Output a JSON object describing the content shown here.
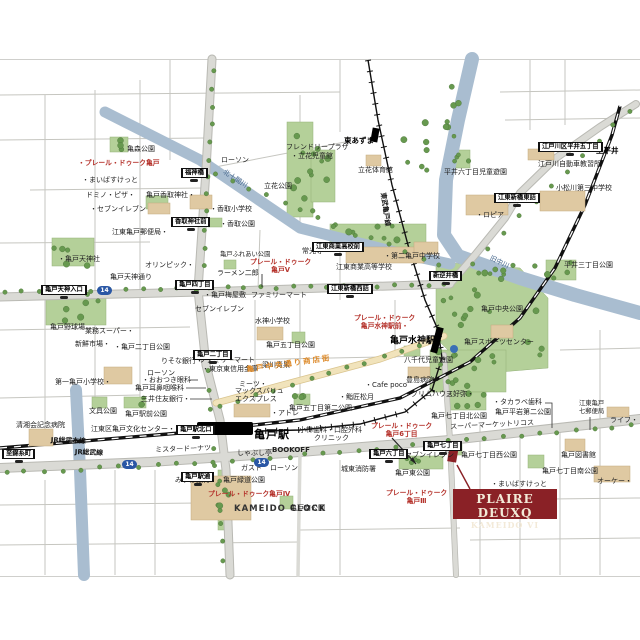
{
  "colors": {
    "brand_red": "#b5332c",
    "logo_red": "#8a2126",
    "road_gray": "#dadad5",
    "park_green": "#b4d099",
    "tree_green": "#67994f",
    "water_blue": "#a9bdd0",
    "rail_black": "#111111",
    "shop_street_orange": "#dd8a2a",
    "route_shield_blue": "#2a57a5"
  },
  "brand_box": {
    "line1": "PLAIRE DEUXQ",
    "line2": "KAMEIDO VI"
  },
  "map": {
    "labels": [
      {
        "text": "亀森公園",
        "x": 127,
        "y": 145
      },
      {
        "text": "・プレール・ドゥーク亀戸",
        "x": 78,
        "y": 159,
        "cls": "br",
        "name": "brand-label-kameido"
      },
      {
        "text": "・まいばすけっと",
        "x": 82,
        "y": 176
      },
      {
        "text": "ドミノ・ピザ・",
        "x": 86,
        "y": 191
      },
      {
        "text": "・セブンイレブン",
        "x": 90,
        "y": 205
      },
      {
        "text": "亀戸香取神社・",
        "x": 146,
        "y": 191
      },
      {
        "text": "ローソン",
        "x": 221,
        "y": 156
      },
      {
        "text": "・香取小学校",
        "x": 210,
        "y": 205
      },
      {
        "text": "・香取公園",
        "x": 220,
        "y": 220
      },
      {
        "text": "フレンドリープラザ",
        "x": 286,
        "y": 143
      },
      {
        "text": "・立花児童館",
        "x": 291,
        "y": 152
      },
      {
        "text": "立花公園",
        "x": 264,
        "y": 182
      },
      {
        "text": "東あずま",
        "x": 344,
        "y": 136,
        "cls": "pb",
        "name": "station-label-higashiazuma"
      },
      {
        "text": "立花体育館",
        "x": 358,
        "y": 166
      },
      {
        "text": "江戸川自動車教習所",
        "x": 538,
        "y": 160
      },
      {
        "text": "平井六丁目児童遊園",
        "x": 444,
        "y": 168
      },
      {
        "text": "小松川第三中学校",
        "x": 556,
        "y": 184
      },
      {
        "text": "・ロピア",
        "x": 476,
        "y": 211
      },
      {
        "text": "至平井",
        "x": 596,
        "y": 146,
        "cls": "pb"
      },
      {
        "text": "北十間川",
        "x": 226,
        "y": 168,
        "cls": "wt",
        "rot": 33,
        "name": "river-label-kitajukken"
      },
      {
        "text": "旧中川",
        "x": 492,
        "y": 254,
        "cls": "wt",
        "rot": 26,
        "name": "river-label-kyunakagawa"
      },
      {
        "text": "東武亀戸線",
        "x": 387,
        "y": 192,
        "cls": "rl",
        "rot": 82,
        "name": "rail-label-tobu"
      },
      {
        "text": "平井三丁目公園",
        "x": 564,
        "y": 261
      },
      {
        "text": "江東亀戸郵便局・",
        "x": 112,
        "y": 228
      },
      {
        "text": "・亀戸天神社",
        "x": 58,
        "y": 255
      },
      {
        "text": "オリンピック・",
        "x": 145,
        "y": 261
      },
      {
        "text": "亀戸天神通り",
        "x": 110,
        "y": 273
      },
      {
        "text": "ラーメン二郎",
        "x": 217,
        "y": 269
      },
      {
        "text": "亀戸ふれあい公園",
        "x": 220,
        "y": 251,
        "cls": "p2"
      },
      {
        "text": "・亀戸梅屋敷",
        "x": 204,
        "y": 291
      },
      {
        "text": "セブンイレブン",
        "x": 195,
        "y": 305
      },
      {
        "text": "常光寺・",
        "x": 302,
        "y": 247
      },
      {
        "text": "江東商業高等学校",
        "x": 336,
        "y": 263
      },
      {
        "text": "・第二亀戸中学校",
        "x": 384,
        "y": 252
      },
      {
        "text": "ファミリーマート",
        "x": 251,
        "y": 291
      },
      {
        "text": "プレール・ドゥーク\n亀戸V",
        "x": 250,
        "y": 258,
        "cls": "br2",
        "name": "brand-label-kameido-v"
      },
      {
        "text": "水神小学校",
        "x": 255,
        "y": 317
      },
      {
        "text": "亀戸五丁目公園",
        "x": 266,
        "y": 341
      },
      {
        "text": "プレール・ドゥーク\n亀戸水神駅前・",
        "x": 354,
        "y": 314,
        "cls": "br2",
        "name": "brand-label-suijin-ekimae"
      },
      {
        "text": "亀戸水神駅",
        "x": 390,
        "y": 336,
        "cls": "st2",
        "name": "station-label-kameido-suijin"
      },
      {
        "text": "亀戸中央公園",
        "x": 481,
        "y": 305
      },
      {
        "text": "亀戸スポーツセンター",
        "x": 464,
        "y": 338
      },
      {
        "text": "・タカラベ歯科",
        "x": 493,
        "y": 398
      },
      {
        "text": "江東亀戸\n七郵便局",
        "x": 579,
        "y": 400,
        "cls": "p2"
      },
      {
        "text": "ライフ・",
        "x": 610,
        "y": 416
      },
      {
        "text": "亀戸野球場",
        "x": 50,
        "y": 323
      },
      {
        "text": "業務スーパー・",
        "x": 85,
        "y": 327
      },
      {
        "text": "新鮮市場・",
        "x": 75,
        "y": 340
      },
      {
        "text": "・亀戸二丁目公園",
        "x": 114,
        "y": 343
      },
      {
        "text": "りそな銀行・",
        "x": 161,
        "y": 357
      },
      {
        "text": "ファミリーマート",
        "x": 199,
        "y": 356
      },
      {
        "text": "・東京東信用金庫",
        "x": 202,
        "y": 365
      },
      {
        "text": "ローソン",
        "x": 147,
        "y": 369
      },
      {
        "text": "・おおつき眼科",
        "x": 142,
        "y": 376
      },
      {
        "text": "亀戸耳鼻咽喉科",
        "x": 135,
        "y": 384
      },
      {
        "text": "三井住友銀行・",
        "x": 141,
        "y": 395
      },
      {
        "text": "第一亀戸小学校・",
        "x": 55,
        "y": 378
      },
      {
        "text": "文具公園",
        "x": 89,
        "y": 407
      },
      {
        "text": "亀戸駅前公園",
        "x": 125,
        "y": 410
      },
      {
        "text": "清湘会記念病院",
        "x": 16,
        "y": 421
      },
      {
        "text": "江東区亀戸文化センター・",
        "x": 91,
        "y": 425
      },
      {
        "text": "JR総武本線",
        "x": 51,
        "y": 436,
        "cls": "rl",
        "rot": 2,
        "name": "rail-label-jr-sobu-main"
      },
      {
        "text": "JR総武線",
        "x": 75,
        "y": 448,
        "cls": "rl",
        "rot": 2,
        "name": "rail-label-jr-sobu"
      },
      {
        "text": "ミスタードーナツ",
        "x": 155,
        "y": 446,
        "rot": -2
      },
      {
        "text": "しゃぶし亭",
        "x": 237,
        "y": 449
      },
      {
        "text": "BOOKOFF",
        "x": 272,
        "y": 446,
        "cls": "lt2"
      },
      {
        "text": "ガスト",
        "x": 241,
        "y": 464
      },
      {
        "text": "ローソン",
        "x": 270,
        "y": 464
      },
      {
        "text": "みずほ銀行",
        "x": 175,
        "y": 476
      },
      {
        "text": "亀戸緑道公園",
        "x": 223,
        "y": 476
      },
      {
        "text": "・アトレ",
        "x": 271,
        "y": 409
      },
      {
        "text": "亀戸駅",
        "x": 254,
        "y": 428,
        "cls": "st",
        "name": "station-label-kameido"
      },
      {
        "text": "KAMEIDO CLOCK",
        "x": 234,
        "y": 504,
        "cls": "lt"
      },
      {
        "text": "亀戸南公園",
        "x": 290,
        "y": 504
      },
      {
        "text": "プレール・ドゥーク亀戸Ⅳ",
        "x": 208,
        "y": 490,
        "cls": "br",
        "name": "brand-label-kameido-iv"
      },
      {
        "text": "プレール・ドゥーク\n亀戸Ⅲ",
        "x": 386,
        "y": 489,
        "cls": "br2",
        "name": "brand-label-kameido-iii"
      },
      {
        "text": "小林歯科・口腔外科",
        "x": 299,
        "y": 426
      },
      {
        "text": "クリニック",
        "x": 314,
        "y": 434
      },
      {
        "text": "プレール・ドゥーク\n亀戸6丁目",
        "x": 371,
        "y": 422,
        "cls": "br2",
        "name": "brand-label-kameido-6chome"
      },
      {
        "text": "城東消防署",
        "x": 341,
        "y": 465
      },
      {
        "text": "セブンイレブン",
        "x": 405,
        "y": 451
      },
      {
        "text": "亀戸東公園",
        "x": 395,
        "y": 469
      },
      {
        "text": "梁川青果",
        "x": 262,
        "y": 361
      },
      {
        "text": "亀戸中央通り商店街",
        "x": 246,
        "y": 365,
        "cls": "os",
        "rot": -8,
        "name": "shopping-street-label"
      },
      {
        "text": "ミーツ・",
        "x": 239,
        "y": 380
      },
      {
        "text": "マックスバリュ\nエクスプレス",
        "x": 235,
        "y": 387
      },
      {
        "text": "・鮨匠松月",
        "x": 339,
        "y": 393
      },
      {
        "text": "・Cafe poco",
        "x": 365,
        "y": 381
      },
      {
        "text": "・グリムハウス",
        "x": 404,
        "y": 390
      },
      {
        "text": "三好弥・",
        "x": 446,
        "y": 390
      },
      {
        "text": "豊島病院",
        "x": 406,
        "y": 376
      },
      {
        "text": "八千代児童遊園",
        "x": 404,
        "y": 356
      },
      {
        "text": "亀戸五丁目第二公園",
        "x": 289,
        "y": 404
      },
      {
        "text": "亀戸七丁目北公園",
        "x": 431,
        "y": 412
      },
      {
        "text": "亀戸平岩第二公園",
        "x": 495,
        "y": 408
      },
      {
        "text": "スーパーマーケットリコス",
        "x": 450,
        "y": 423,
        "rot": -3
      },
      {
        "text": "亀戸図書館",
        "x": 561,
        "y": 451
      },
      {
        "text": "亀戸七丁目西公園",
        "x": 461,
        "y": 451
      },
      {
        "text": "亀戸七丁目南公園",
        "x": 542,
        "y": 467
      },
      {
        "text": "・まいばすけっと",
        "x": 491,
        "y": 480
      },
      {
        "text": "オーケー・",
        "x": 597,
        "y": 477
      }
    ],
    "bus_stops": [
      {
        "text": "福神橋",
        "x": 181,
        "y": 159
      },
      {
        "text": "香取神社前",
        "x": 171,
        "y": 208
      },
      {
        "text": "亀戸天神入口",
        "x": 41,
        "y": 276
      },
      {
        "text": "亀戸四丁目",
        "x": 175,
        "y": 271
      },
      {
        "text": "亀戸二丁目",
        "x": 193,
        "y": 341
      },
      {
        "text": "江東商業高校前",
        "x": 312,
        "y": 233
      },
      {
        "text": "江東新橋西詰",
        "x": 327,
        "y": 275
      },
      {
        "text": "新逆井橋",
        "x": 429,
        "y": 262
      },
      {
        "text": "江東新橋東詰",
        "x": 494,
        "y": 184
      },
      {
        "text": "江戸川区平井五丁目",
        "x": 538,
        "y": 133
      },
      {
        "text": "亀戸駅北口",
        "x": 176,
        "y": 416
      },
      {
        "text": "亀戸駅通",
        "x": 181,
        "y": 463
      },
      {
        "text": "亀戸六丁目",
        "x": 369,
        "y": 440
      },
      {
        "text": "亀戸七丁目",
        "x": 423,
        "y": 432
      },
      {
        "text": "至錦糸町",
        "x": 2,
        "y": 440
      }
    ],
    "shields": [
      {
        "text": "14",
        "x": 97,
        "y": 286
      },
      {
        "text": "14",
        "x": 122,
        "y": 460
      },
      {
        "text": "14",
        "x": 254,
        "y": 458
      }
    ],
    "tree_lines": [
      [
        5,
        292,
        195,
        289,
        12
      ],
      [
        210,
        288,
        445,
        285,
        15
      ],
      [
        214,
        72,
        202,
        282,
        13
      ],
      [
        208,
        372,
        224,
        560,
        11
      ],
      [
        6,
        473,
        290,
        459,
        16
      ],
      [
        305,
        455,
        630,
        425,
        19
      ],
      [
        456,
        278,
        630,
        110,
        12
      ],
      [
        215,
        175,
        440,
        266,
        14
      ],
      [
        220,
        407,
        438,
        341,
        13
      ]
    ],
    "tree_clusters": [
      [
        288,
        124,
        42,
        90,
        13
      ],
      [
        438,
        264,
        106,
        104,
        26
      ],
      [
        430,
        352,
        72,
        38,
        9
      ],
      [
        446,
        84,
        18,
        95,
        7
      ],
      [
        390,
        118,
        46,
        56,
        7
      ],
      [
        447,
        151,
        22,
        16,
        4
      ],
      [
        547,
        261,
        28,
        18,
        4
      ],
      [
        332,
        226,
        92,
        20,
        7
      ],
      [
        48,
        294,
        56,
        30,
        6
      ],
      [
        54,
        240,
        40,
        26,
        5
      ],
      [
        446,
        393,
        38,
        16,
        5
      ],
      [
        400,
        457,
        42,
        11,
        4
      ],
      [
        219,
        472,
        10,
        56,
        5
      ],
      [
        294,
        395,
        14,
        9,
        3
      ],
      [
        110,
        138,
        16,
        13,
        3
      ],
      [
        124,
        398,
        20,
        9,
        3
      ]
    ]
  }
}
